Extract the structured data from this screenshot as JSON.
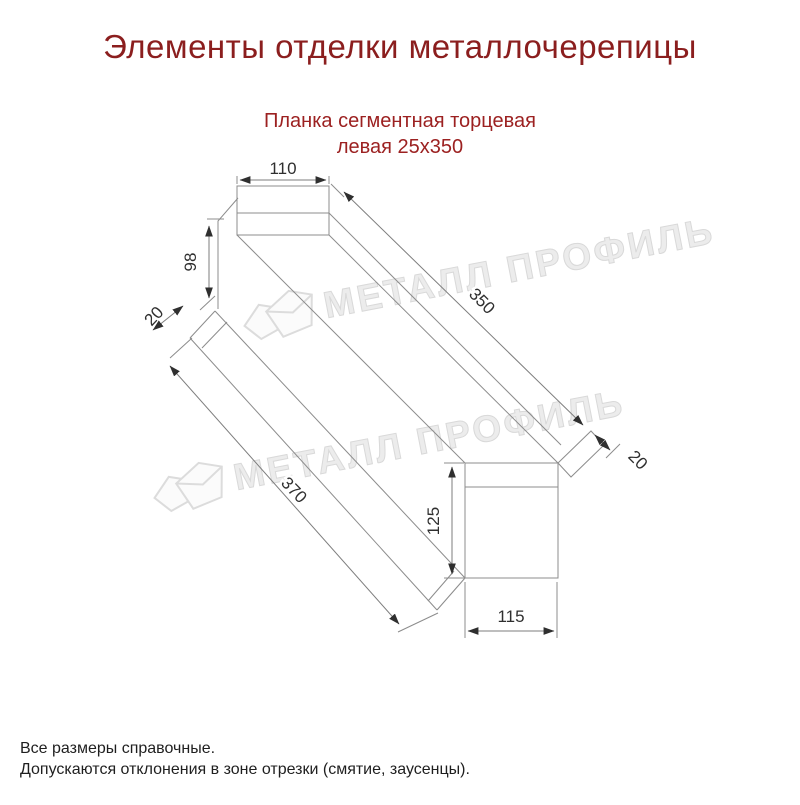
{
  "title": "Элементы отделки металлочерепицы",
  "product": {
    "name_line1": "Планка сегментная торцевая",
    "name_line2": "левая 25х350"
  },
  "watermark": {
    "brand": "МЕТАЛЛ ПРОФИЛЬ",
    "color": "#ececec"
  },
  "drawing": {
    "type": "technical-dimension-drawing",
    "dims": {
      "d110": {
        "label": "110"
      },
      "d98": {
        "label": "98"
      },
      "d20_left": {
        "label": "20"
      },
      "d350": {
        "label": "350"
      },
      "d20_right": {
        "label": "20"
      },
      "d370": {
        "label": "370"
      },
      "d125": {
        "label": "125"
      },
      "d115": {
        "label": "115"
      }
    }
  },
  "notes": {
    "line1": "Все размеры справочные.",
    "line2": "Допускаются отклонения в зоне отрезки (смятие, заусенцы)."
  },
  "colors": {
    "heading": "#8b1e1e",
    "subtitle": "#9c2121",
    "object_line": "#8c8c8c",
    "dimension_text": "#2f2f2f",
    "note_text": "#1f1f1f",
    "background": "#ffffff"
  }
}
